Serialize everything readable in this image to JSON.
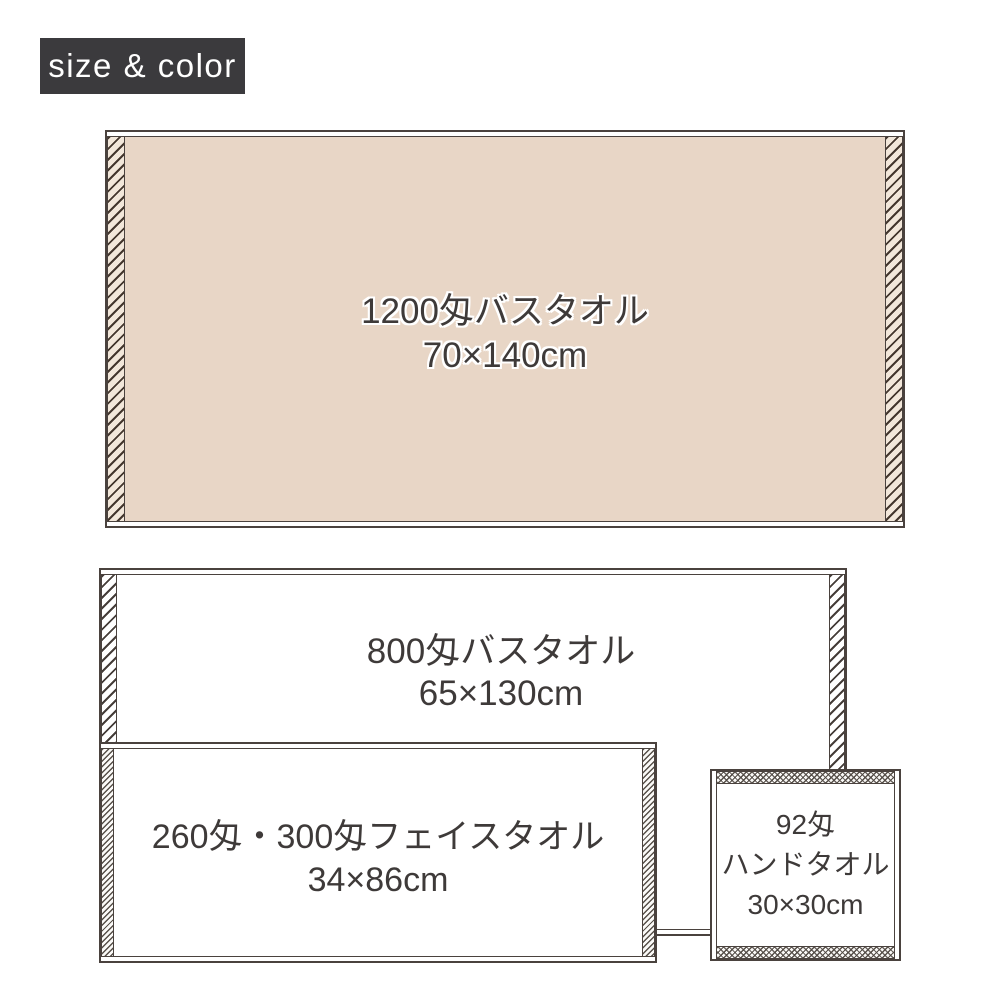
{
  "badge": {
    "label": "size & color",
    "bg_color": "#3b3a3d",
    "text_color": "#ffffff"
  },
  "towels": {
    "bath1200": {
      "name": "1200匁バスタオル",
      "size": "70×140cm",
      "fill_color": "#e8d6c6",
      "edge_style": "coarse-hatch-beige"
    },
    "bath800": {
      "name": "800匁バスタオル",
      "size": "65×130cm",
      "fill_color": "#ffffff",
      "edge_style": "coarse-hatch-white"
    },
    "face": {
      "name": "260匁・300匁フェイスタオル",
      "size": "34×86cm",
      "fill_color": "#ffffff",
      "edge_style": "fine-hatch-white"
    },
    "hand": {
      "name": "92匁",
      "name2": "ハンドタオル",
      "size": "30×30cm",
      "fill_color": "#ffffff",
      "edge_style": "fine-crosshatch-white"
    }
  },
  "colors": {
    "outline": "#4a423e",
    "hatch_line_dark": "#43362d",
    "label_text": "#3e3a39",
    "beige_fill": "#e8d6c6",
    "hatch_bg_beige": "#f2e7da"
  }
}
